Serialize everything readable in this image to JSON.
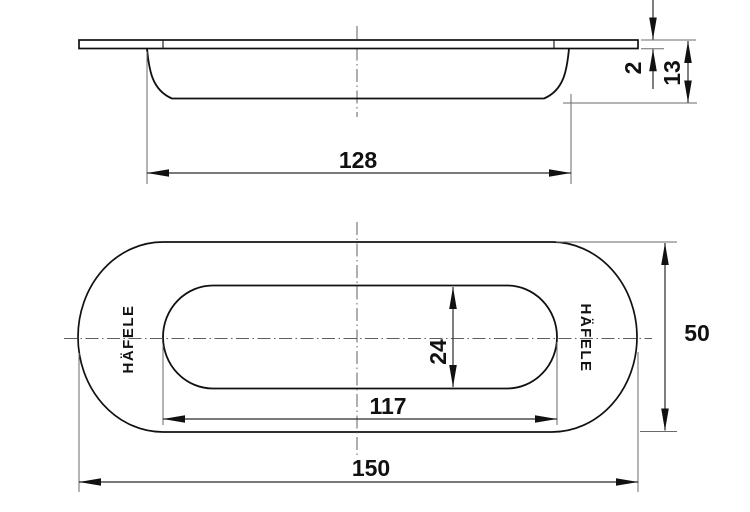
{
  "brand": "HÄFELE",
  "side_view": {
    "dim_recess_width": "128",
    "dim_flange_thickness": "2",
    "dim_total_depth": "13"
  },
  "plan_view": {
    "dim_inner_length": "117",
    "dim_inner_width": "24",
    "dim_overall_length": "150",
    "dim_overall_width": "50"
  },
  "colors": {
    "object_line": "#111111",
    "dimension_line": "#2a2a2a",
    "extension_line": "#6a6a6a",
    "centerline": "#5f5f5f",
    "background": "#ffffff"
  }
}
